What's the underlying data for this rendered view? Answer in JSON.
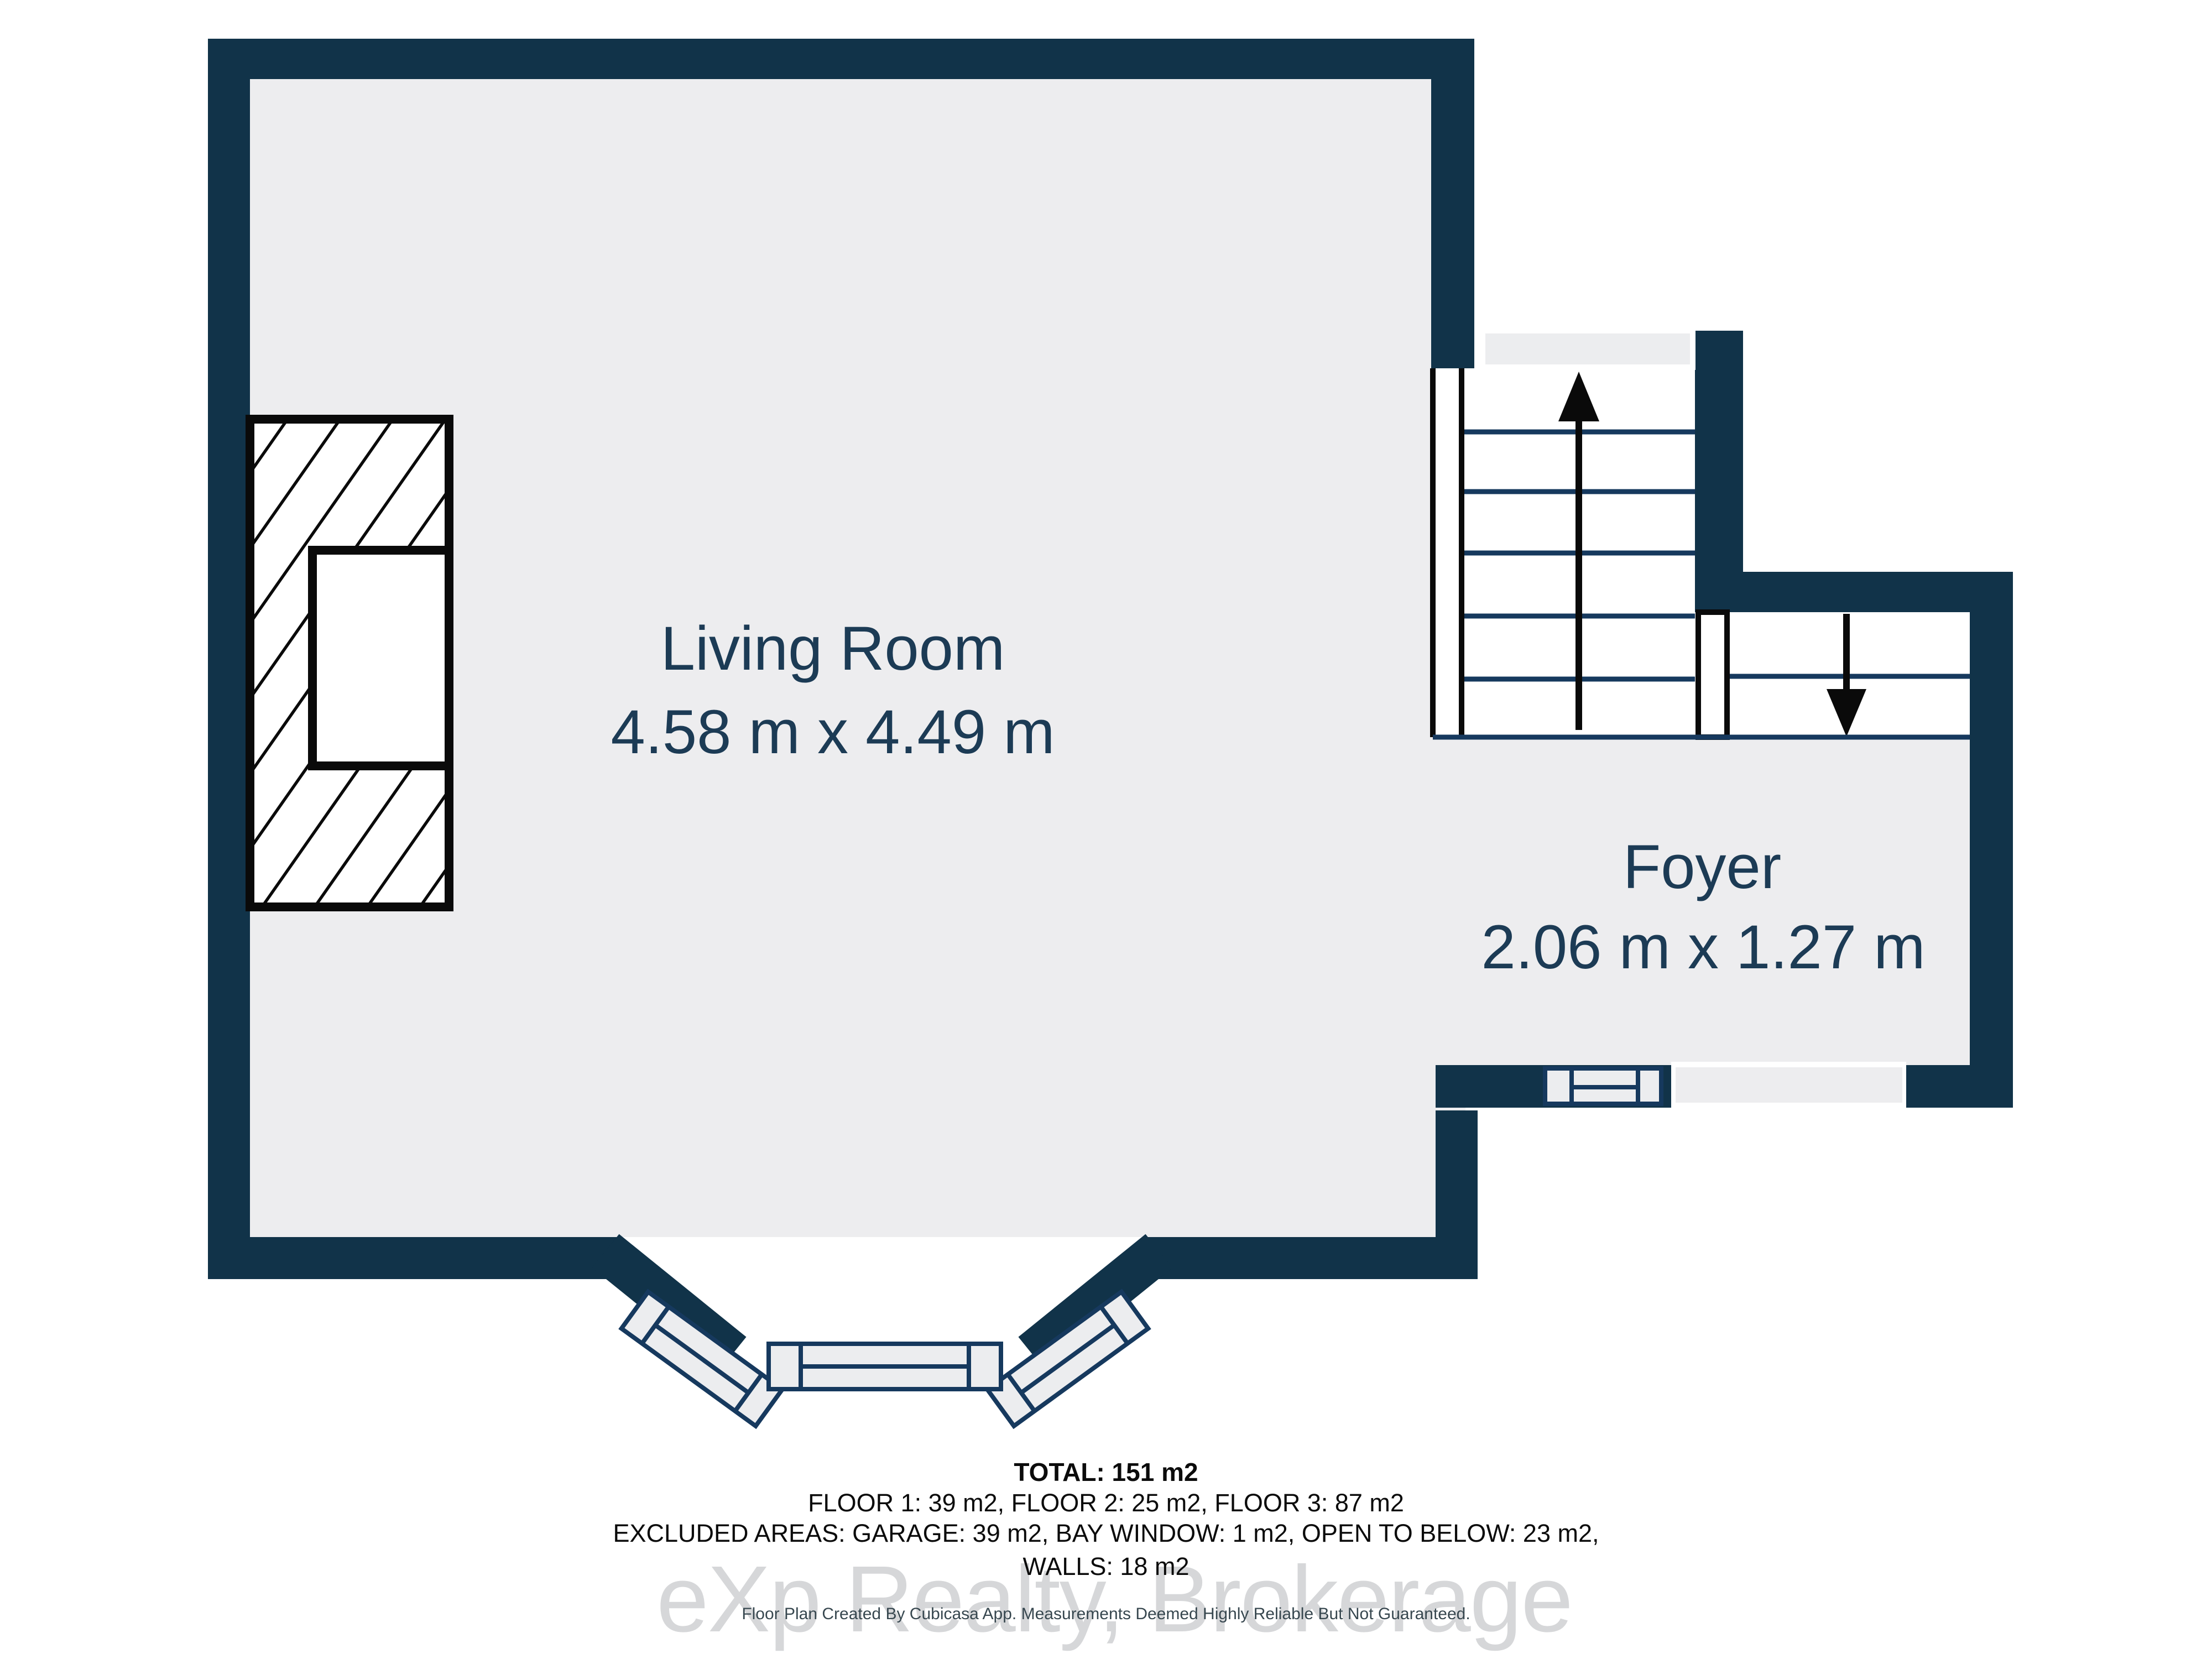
{
  "plan": {
    "type": "floor-plan",
    "rooms": [
      {
        "name": "Living Room",
        "dims": "4.58 m x 4.49 m"
      },
      {
        "name": "Foyer",
        "dims": "2.06 m x 1.27 m"
      }
    ],
    "icons": {
      "stairs_up": "arrow-up",
      "stairs_down": "arrow-down"
    }
  },
  "footer": {
    "total": "TOTAL: 151 m2",
    "floors": "FLOOR 1: 39 m2, FLOOR 2: 25 m2, FLOOR 3: 87 m2",
    "excluded": "EXCLUDED AREAS: GARAGE: 39 m2, BAY WINDOW: 1 m2, OPEN TO BELOW: 23 m2,",
    "walls": "WALLS: 18 m2",
    "disclaimer": "Floor Plan Created By Cubicasa App. Measurements Deemed Highly Reliable But Not Guaranteed."
  },
  "watermark": {
    "text": "eXp Realty, Brokerage"
  },
  "colors": {
    "wall": "#113349",
    "floor": "#EDEDEF",
    "stair_line": "#16395E",
    "room_label": "#1C3B55",
    "footer_text": "#0B0B0B",
    "disclaimer_text": "#37474F",
    "watermark": "#D6D7D9",
    "background": "#FFFFFF"
  }
}
